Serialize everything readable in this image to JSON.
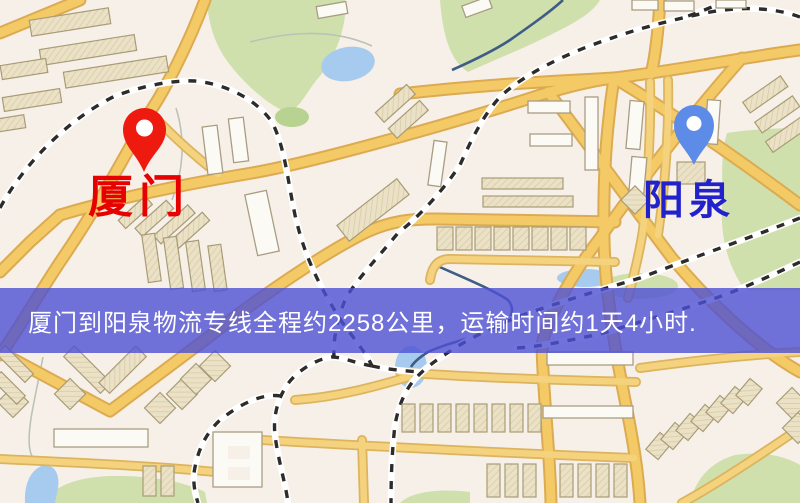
{
  "banner": {
    "text": "厦门到阳泉物流专线全程约2258公里，运输时间约1天4小时.",
    "background": "rgba(77, 80, 212, 0.80)",
    "text_color": "#ffffff"
  },
  "markers": [
    {
      "id": "origin",
      "city": "厦门",
      "pin_color": "#ee1a10",
      "pin_hole_color": "#ffffff",
      "label_color": "#e60000"
    },
    {
      "id": "destination",
      "city": "阳泉",
      "pin_color": "#5d8ce8",
      "pin_hole_color": "#ffffff",
      "label_color": "#2222cc"
    }
  ],
  "map_palette": {
    "background": "#f7f0e9",
    "road_fill": "#f4ca67",
    "road_casing": "#dcab51",
    "railway_dash": "#2e2c2a",
    "green_area": "#cfe0ad",
    "water": "#a7cbee",
    "building_beige": "#ebe1c6",
    "building_white": "#fcfaf5"
  }
}
